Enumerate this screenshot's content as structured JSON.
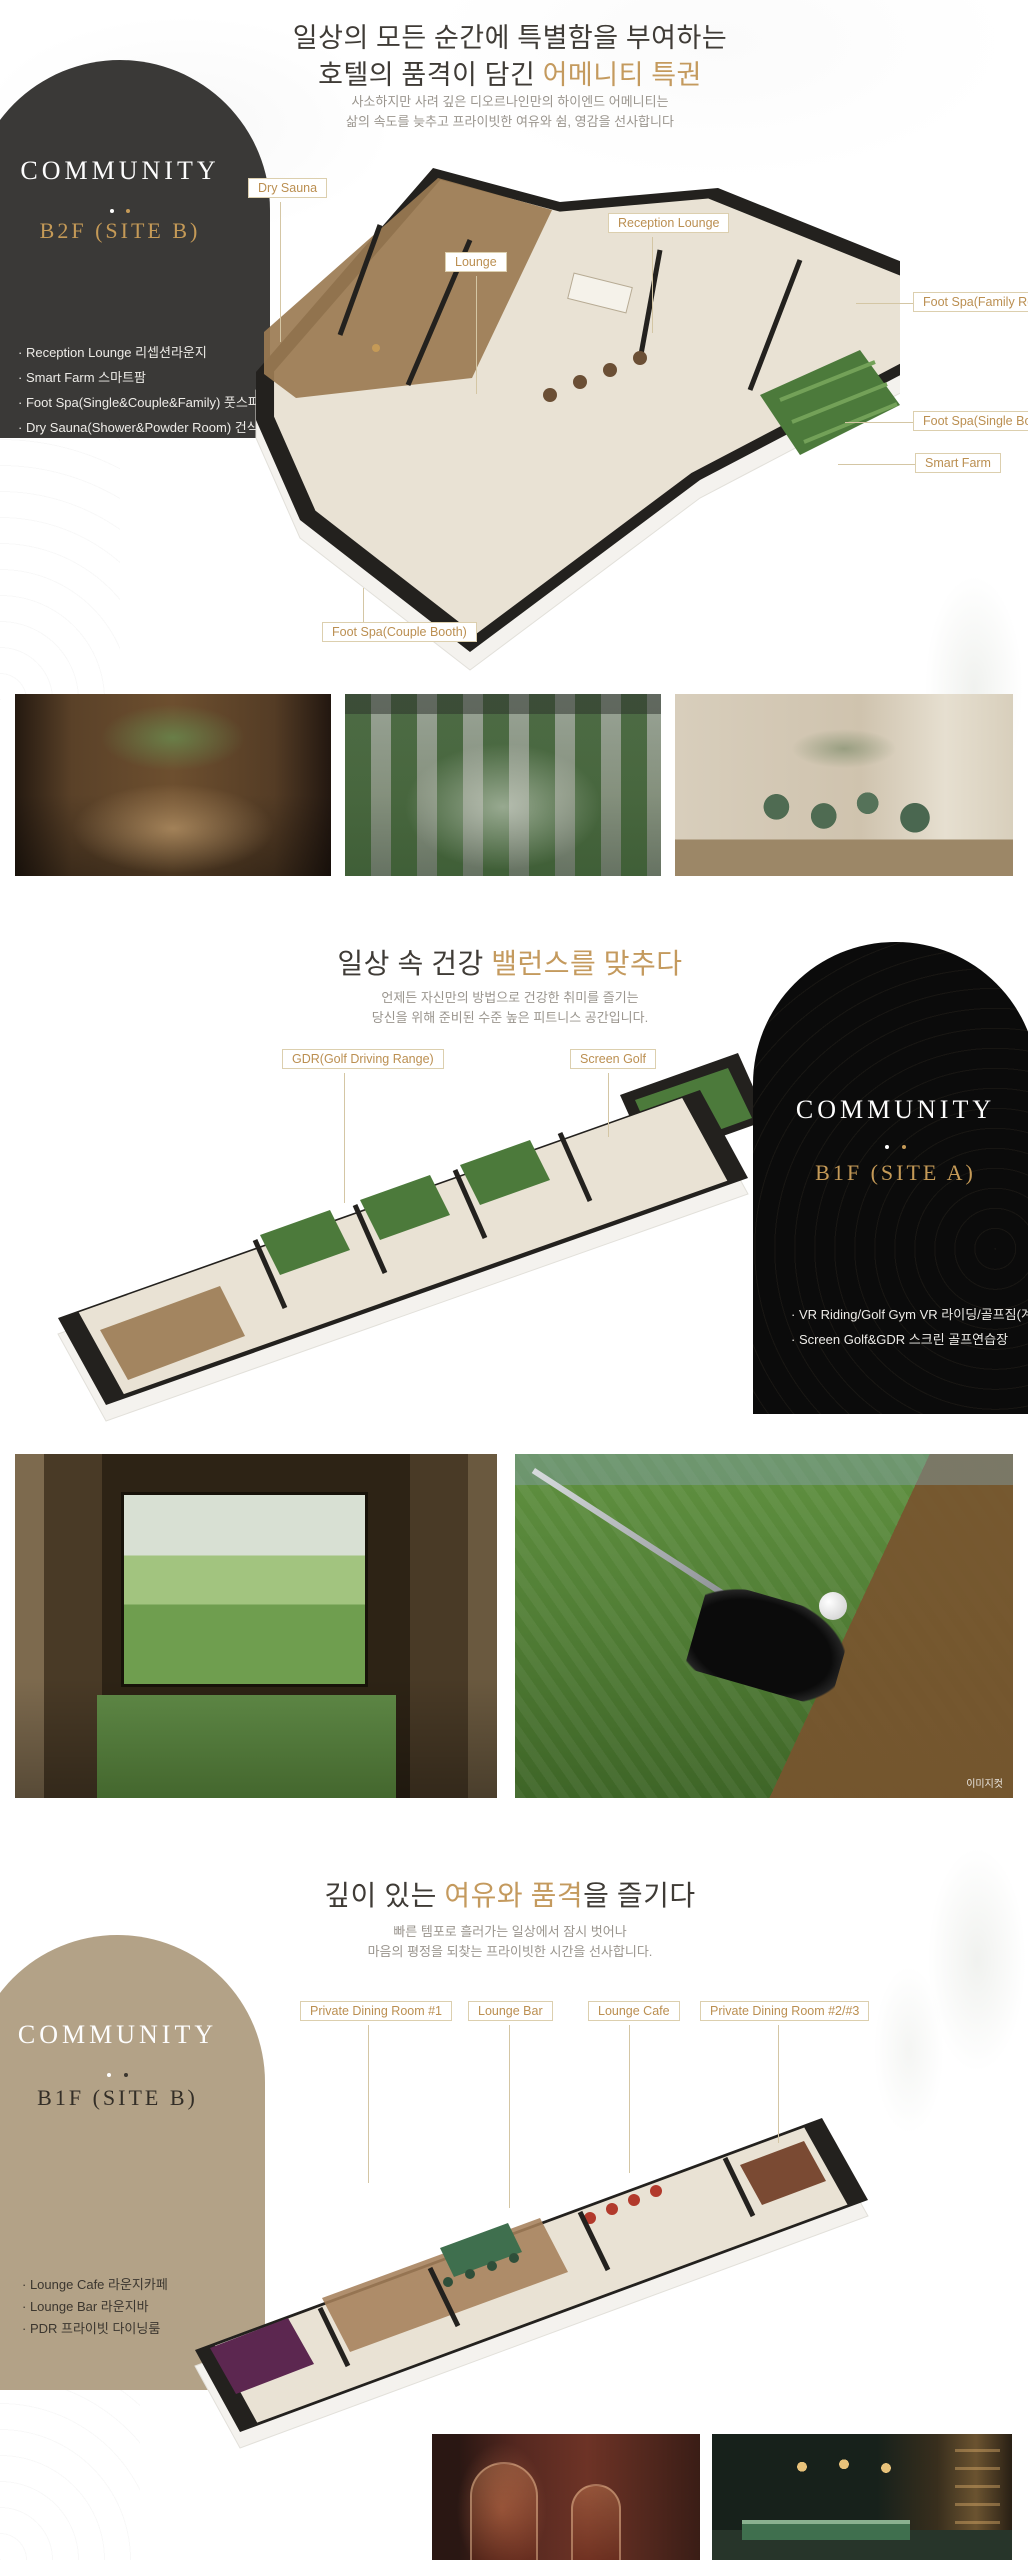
{
  "colors": {
    "accent_gold": "#c49a5e",
    "badge_dark": "#3a3937",
    "badge_black": "#0b0b0b",
    "badge_tan": "#b3a287",
    "label_text": "#bb8f51"
  },
  "sections": {
    "b2f_site_b": {
      "heading": {
        "line1": "일상의 모든 순간에 특별함을 부여하는",
        "line2_prefix": "호텔의 품격이 담긴 ",
        "line2_accent": "어메니티 특권"
      },
      "subheading": {
        "line1": "사소하지만 사려 깊은 디오르나인만의 하이엔드 어메니티는",
        "line2": "삶의 속도를 늦추고 프라이빗한 여유와 쉼, 영감을 선사합니다"
      },
      "badge": {
        "name": "COMMUNITY",
        "floor": "B2F (SITE B)",
        "items": [
          "Reception Lounge 리셉션라운지",
          "Smart Farm 스마트팜",
          "Foot Spa(Single&Couple&Family) 풋스파",
          "Dry Sauna(Shower&Powder Room) 건식 사우나"
        ]
      },
      "plan_labels": {
        "dry_sauna": "Dry Sauna",
        "lounge": "Lounge",
        "reception_lounge": "Reception Lounge",
        "foot_spa_family": "Foot Spa(Family Room)",
        "foot_spa_single": "Foot Spa(Single Booth)",
        "smart_farm": "Smart Farm",
        "foot_spa_couple": "Foot Spa(Couple Booth)"
      }
    },
    "b1f_site_a": {
      "heading": {
        "line1_prefix": "일상 속 건강 ",
        "line1_accent": "밸런스를 맞추다"
      },
      "subheading": {
        "line1": "언제든 자신만의 방법으로 건강한 취미를 즐기는",
        "line2": "당신을 위해 준비된 수준 높은 피트니스 공간입니다."
      },
      "badge": {
        "name": "COMMUNITY",
        "floor": "B1F (SITE A)",
        "items": [
          "VR Riding/Golf Gym VR 라이딩/골프짐(계획)",
          "Screen Golf&GDR 스크린 골프연습장"
        ]
      },
      "plan_labels": {
        "gdr": "GDR(Golf Driving Range)",
        "screen_golf": "Screen Golf"
      },
      "photo_caption": "이미지컷"
    },
    "b1f_site_b": {
      "heading": {
        "prefix": "깊이 있는 ",
        "accent": "여유와 품격",
        "suffix": "을 즐기다"
      },
      "subheading": {
        "line1": "빠른 템포로 흘러가는 일상에서 잠시 벗어나",
        "line2": "마음의 평정을 되찾는 프라이빗한 시간을 선사합니다."
      },
      "badge": {
        "name": "COMMUNITY",
        "floor": "B1F (SITE B)",
        "items": [
          "Lounge Cafe 라운지카페",
          "Lounge Bar 라운지바",
          "PDR 프라이빗 다이닝룸"
        ]
      },
      "plan_labels": {
        "pdr1": "Private Dining Room #1",
        "lounge_bar": "Lounge Bar",
        "lounge_cafe": "Lounge Cafe",
        "pdr23": "Private Dining Room #2/#3"
      }
    }
  }
}
